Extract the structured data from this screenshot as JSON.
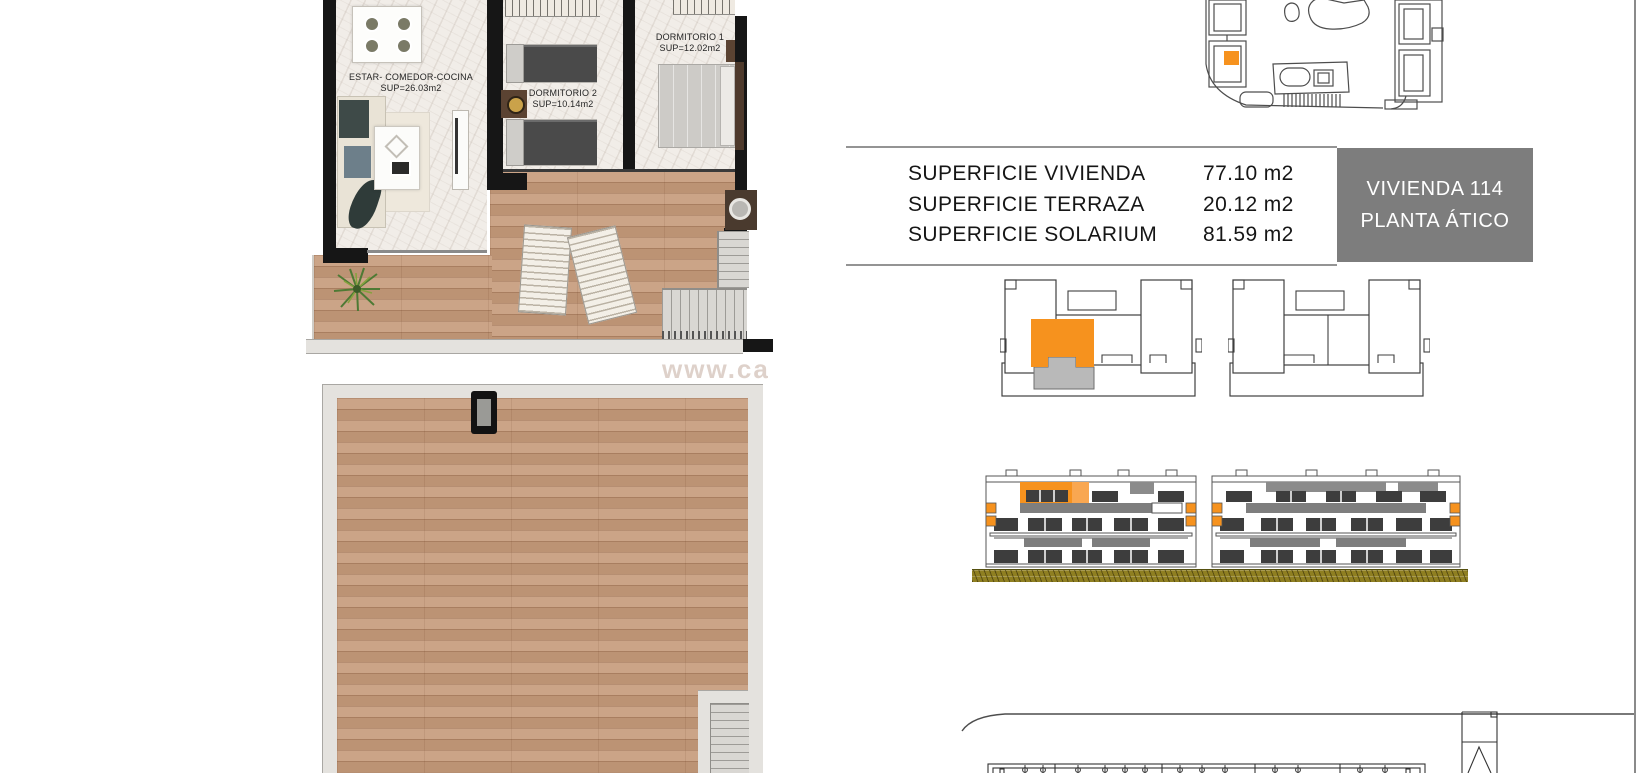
{
  "title_badge": {
    "line1": "VIVIENDA 114",
    "line2": "PLANTA ÁTICO"
  },
  "surface_table": {
    "rows": [
      {
        "label": "SUPERFICIE VIVIENDA",
        "value": "77.10 m2"
      },
      {
        "label": "SUPERFICIE TERRAZA",
        "value": "20.12 m2"
      },
      {
        "label": "SUPERFICIE SOLARIUM",
        "value": "81.59 m2"
      }
    ]
  },
  "floor_plan": {
    "rooms": [
      {
        "name": "ESTAR- COMEDOR-COCINA",
        "area": "SUP=26.03m2"
      },
      {
        "name": "DORMITORIO 2",
        "area": "SUP=10.14m2"
      },
      {
        "name": "DORMITORIO 1",
        "area": "SUP=12.02m2"
      }
    ]
  },
  "watermark": "www.ca",
  "colors": {
    "accent_orange": "#f6921e",
    "accent_orange_light": "#f9a751",
    "badge_gray": "#7d7d7d",
    "ground_olive": "#8f7f21",
    "wood": "#c79d7e"
  }
}
